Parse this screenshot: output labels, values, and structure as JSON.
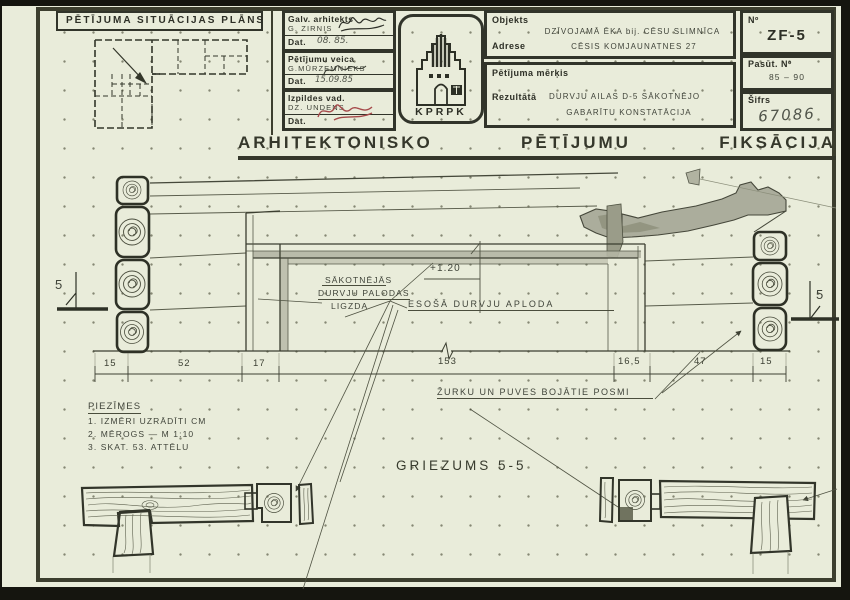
{
  "header": {
    "situation_plan_title": "PĒTĪJUMA SITUĀCIJAS PLĀNS",
    "staff": [
      {
        "role": "Galv. arhitekts",
        "name": "G. ZIRNIS",
        "date_label": "Dat.",
        "date": "08. 85."
      },
      {
        "role": "Pētījumu veica",
        "name": "G.MŪRZEMNIEKS",
        "date_label": "Dat.",
        "date": "15.09.85"
      },
      {
        "role": "Izpildes vad.",
        "name": "DZ. UNDENS",
        "date_label": "Dat.",
        "date": ""
      }
    ],
    "logo_text": "KPRPK",
    "fields": {
      "object_label": "Objekts",
      "object_value": "DZĪVOJAMĀ ĒKA  bij. CĒSU SLIMNĪCA",
      "address_label": "Adrese",
      "address_value": "CĒSIS  KOMJAUNATNES 27",
      "purpose_label": "Pētījuma mērķis",
      "result_label": "Rezultātā",
      "result_value_line1": "DURVJU AILAS D-5 SĀKOTNĒJO",
      "result_value_line2": "GABARĪTU KONSTATĀCIJA",
      "no_label": "Nº",
      "no_value": "ZF-5",
      "order_label": "Pasūt. Nº",
      "order_value": "85 – 90",
      "cipher_label": "Šifrs",
      "cipher_value": "67086"
    },
    "main_title_words": [
      "ARHITEKTONISKO",
      "PĒTĪJUMU",
      "FIKSĀCIJA"
    ]
  },
  "drawing": {
    "level_mark": "+1.20",
    "socket_label_lines": [
      "SĀKOTNĒJĀS",
      "DURVJU PALODAS",
      "LIGZDA"
    ],
    "frame_label": "ESOŠĀ  DURVJU  APLODA",
    "damage_label": "ŽURKU UN PUVES BOJĀTIE POSMI",
    "section_marker": "5",
    "dimensions": [
      "15",
      "52",
      "17",
      "153",
      "16,5",
      "47",
      "15"
    ],
    "notes_title": "PIEZĪMES",
    "notes": [
      "1. IZMĒRI UZRĀDĪTI CM",
      "2. MĒROGS — M 1:10",
      "3. SKAT. 53. ATTĒLU"
    ],
    "section_title": "GRIEZUMS 5-5"
  }
}
